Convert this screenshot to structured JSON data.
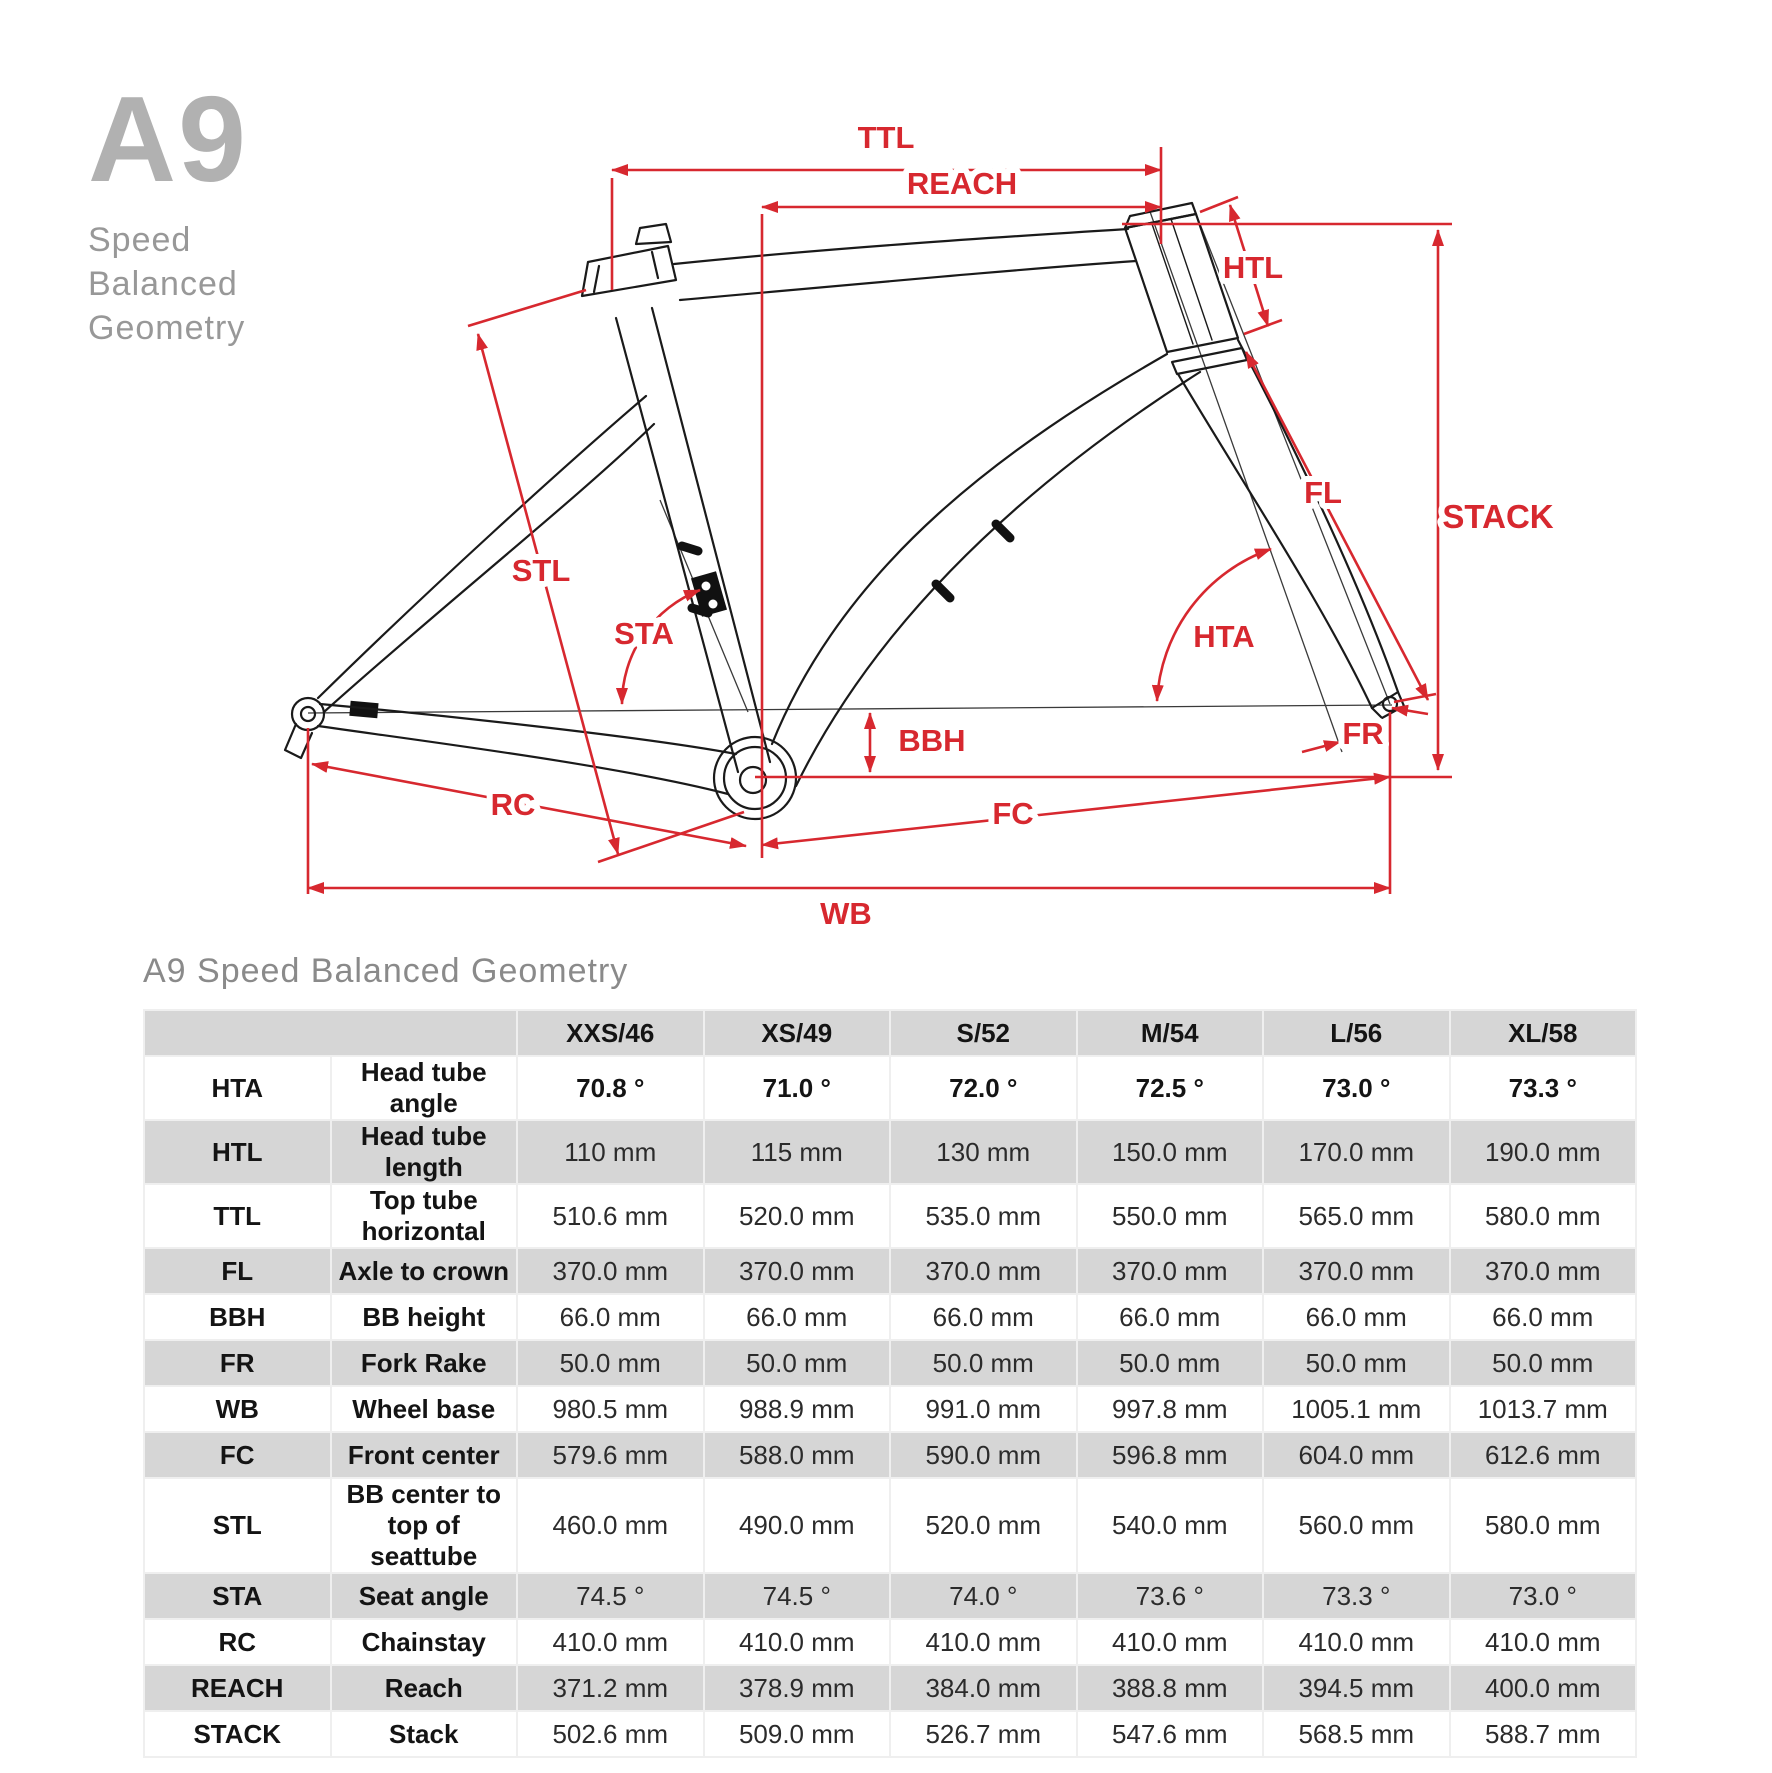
{
  "logo": {
    "title": "A9",
    "subtitle": [
      "Speed",
      "Balanced",
      "Geometry"
    ]
  },
  "diagram": {
    "dimension_labels": {
      "ttl": "TTL",
      "reach": "REACH",
      "htl": "HTL",
      "stack": "STACK",
      "fl": "FL",
      "stl": "STL",
      "sta": "STA",
      "hta": "HTA",
      "bbh": "BBH",
      "fr": "FR",
      "rc": "RC",
      "fc": "FC",
      "wb": "WB"
    },
    "colors": {
      "dimension_red": "#d7282f",
      "frame_black": "#1a1a1a"
    }
  },
  "geometry_table": {
    "title": "A9 Speed Balanced Geometry",
    "columns": [
      "XXS/46",
      "XS/49",
      "S/52",
      "M/54",
      "L/56",
      "XL/58"
    ],
    "rows": [
      {
        "code": "HTA",
        "label": "Head tube angle",
        "bold": true,
        "values": [
          "70.8 °",
          "71.0 °",
          "72.0 °",
          "72.5 °",
          "73.0 °",
          "73.3 °"
        ]
      },
      {
        "code": "HTL",
        "label": "Head tube length",
        "bold": false,
        "values": [
          "110 mm",
          "115 mm",
          "130 mm",
          "150.0 mm",
          "170.0 mm",
          "190.0 mm"
        ]
      },
      {
        "code": "TTL",
        "label": "Top tube horizontal",
        "bold": false,
        "values": [
          "510.6 mm",
          "520.0 mm",
          "535.0 mm",
          "550.0 mm",
          "565.0 mm",
          "580.0 mm"
        ]
      },
      {
        "code": "FL",
        "label": "Axle to crown",
        "bold": false,
        "values": [
          "370.0 mm",
          "370.0 mm",
          "370.0 mm",
          "370.0 mm",
          "370.0 mm",
          "370.0 mm"
        ]
      },
      {
        "code": "BBH",
        "label": "BB height",
        "bold": false,
        "values": [
          "66.0 mm",
          "66.0 mm",
          "66.0 mm",
          "66.0 mm",
          "66.0 mm",
          "66.0 mm"
        ]
      },
      {
        "code": "FR",
        "label": "Fork Rake",
        "bold": false,
        "values": [
          "50.0 mm",
          "50.0 mm",
          "50.0 mm",
          "50.0 mm",
          "50.0 mm",
          "50.0 mm"
        ]
      },
      {
        "code": "WB",
        "label": "Wheel base",
        "bold": false,
        "values": [
          "980.5 mm",
          "988.9 mm",
          "991.0 mm",
          "997.8 mm",
          "1005.1 mm",
          "1013.7 mm"
        ]
      },
      {
        "code": "FC",
        "label": "Front center",
        "bold": false,
        "values": [
          "579.6 mm",
          "588.0 mm",
          "590.0 mm",
          "596.8 mm",
          "604.0 mm",
          "612.6 mm"
        ]
      },
      {
        "code": "STL",
        "label": "BB center to top of seattube",
        "bold": false,
        "values": [
          "460.0 mm",
          "490.0 mm",
          "520.0 mm",
          "540.0 mm",
          "560.0 mm",
          "580.0 mm"
        ]
      },
      {
        "code": "STA",
        "label": "Seat angle",
        "bold": false,
        "values": [
          "74.5 °",
          "74.5 °",
          "74.0 °",
          "73.6 °",
          "73.3 °",
          "73.0 °"
        ]
      },
      {
        "code": "RC",
        "label": "Chainstay",
        "bold": false,
        "values": [
          "410.0 mm",
          "410.0 mm",
          "410.0 mm",
          "410.0 mm",
          "410.0 mm",
          "410.0 mm"
        ]
      },
      {
        "code": "REACH",
        "label": "Reach",
        "bold": false,
        "values": [
          "371.2 mm",
          "378.9 mm",
          "384.0 mm",
          "388.8 mm",
          "394.5 mm",
          "400.0 mm"
        ]
      },
      {
        "code": "STACK",
        "label": "Stack",
        "bold": false,
        "values": [
          "502.6 mm",
          "509.0 mm",
          "526.7 mm",
          "547.6 mm",
          "568.5 mm",
          "588.7 mm"
        ]
      }
    ]
  }
}
